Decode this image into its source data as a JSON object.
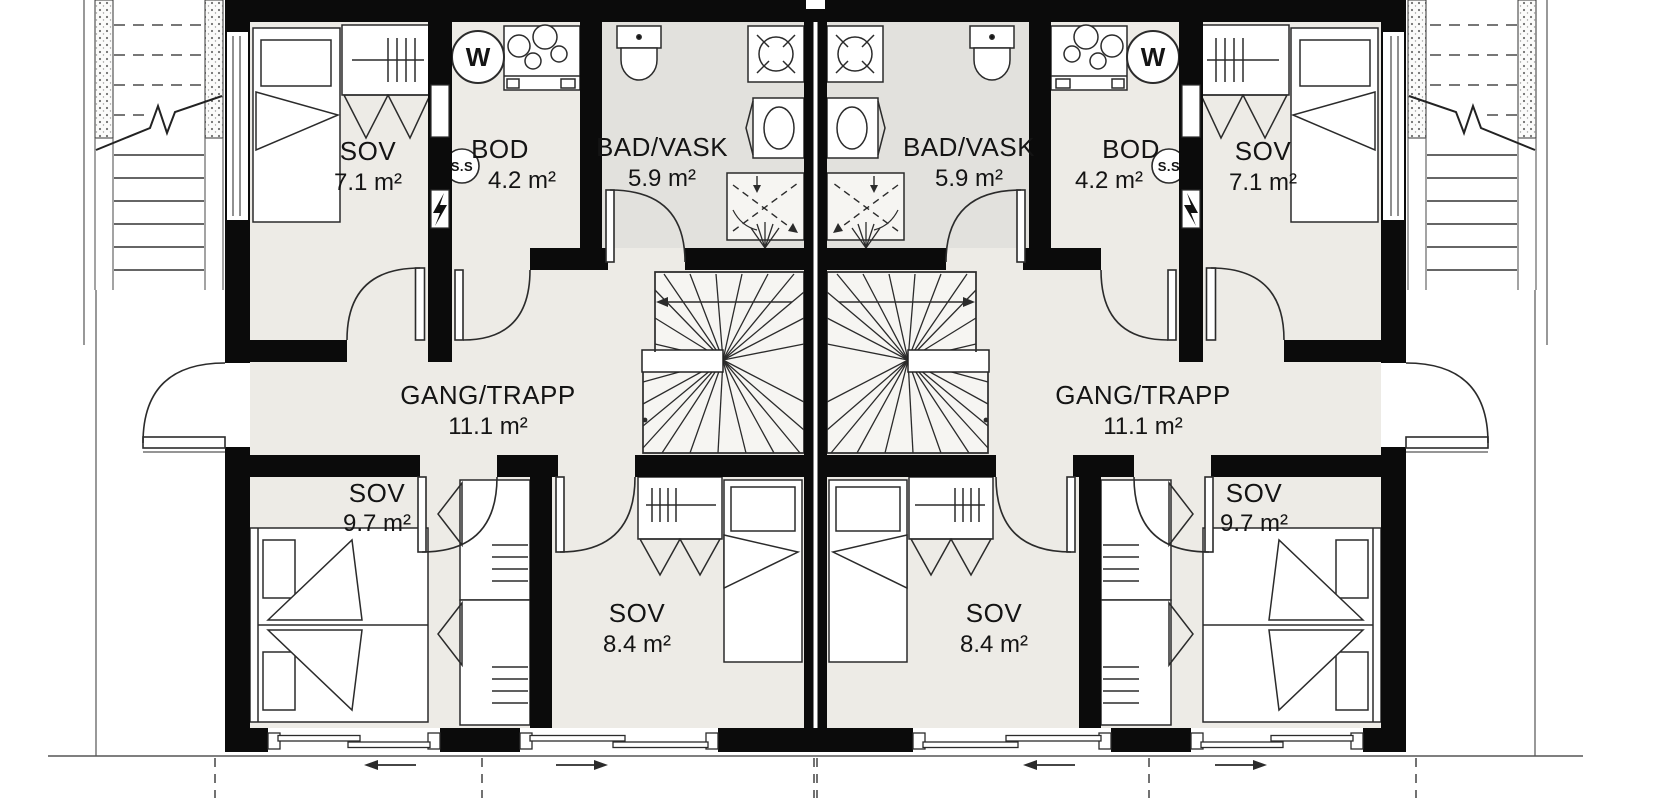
{
  "left": {
    "sov_top": {
      "name": "SOV",
      "area": "7.1 m²"
    },
    "bod": {
      "name": "BOD",
      "area": "4.2 m²"
    },
    "bad": {
      "name": "BAD/VASK",
      "area": "5.9 m²"
    },
    "gang": {
      "name": "GANG/TRAPP",
      "area": "11.1 m²"
    },
    "sov_main": {
      "name": "SOV",
      "area": "9.7 m²"
    },
    "sov_mid": {
      "name": "SOV",
      "area": "8.4 m²"
    },
    "water_heater": "W",
    "ss_cabinet": "S.S"
  },
  "right": {
    "sov_top": {
      "name": "SOV",
      "area": "7.1 m²"
    },
    "bod": {
      "name": "BOD",
      "area": "4.2 m²"
    },
    "bad": {
      "name": "BAD/VASK",
      "area": "5.9 m²"
    },
    "gang": {
      "name": "GANG/TRAPP",
      "area": "11.1 m²"
    },
    "sov_main": {
      "name": "SOV",
      "area": "9.7 m²"
    },
    "sov_mid": {
      "name": "SOV",
      "area": "8.4 m²"
    },
    "water_heater": "W",
    "ss_cabinet": "S.S"
  },
  "colors": {
    "wall": "#0b0b0b",
    "floor": "#edebe6",
    "bath_floor": "#e2e1dd",
    "stair_floor": "#f6f5f2",
    "line": "#2b2b2b"
  }
}
